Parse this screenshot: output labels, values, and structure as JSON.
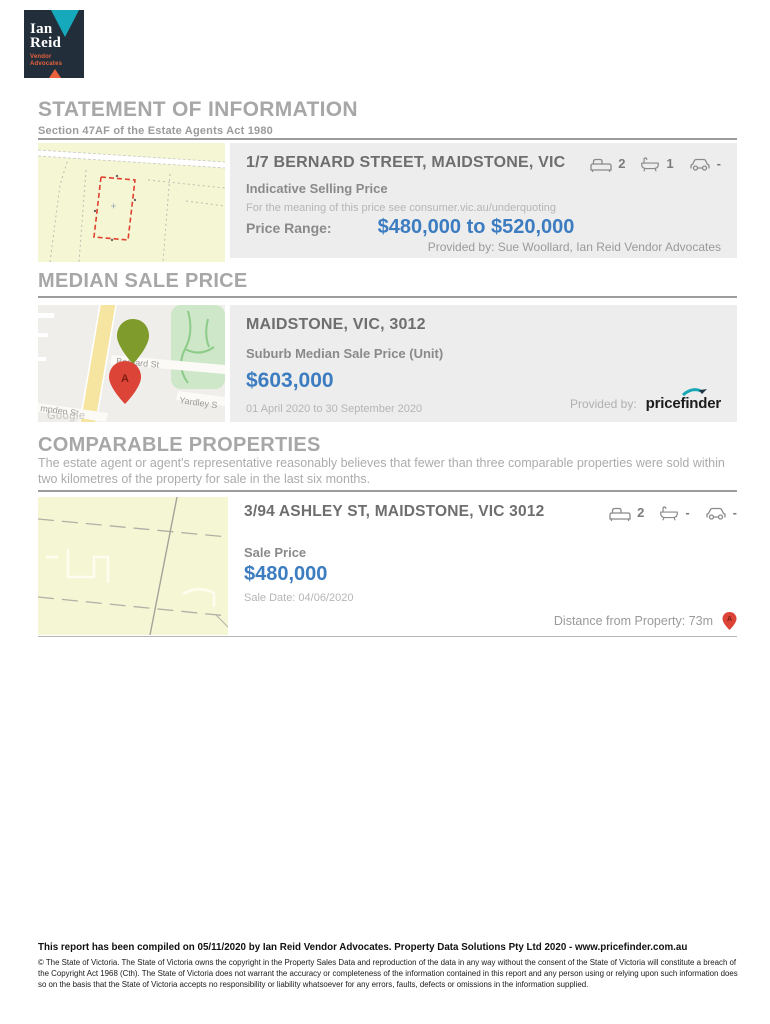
{
  "logo": {
    "name_line1": "Ian",
    "name_line2": "Reid",
    "tagline_line1": "Vendor",
    "tagline_line2": "Advocates"
  },
  "header": {
    "title": "STATEMENT OF INFORMATION",
    "subtitle": "Section 47AF of the Estate Agents Act 1980"
  },
  "subject": {
    "address": "1/7 BERNARD STREET, MAIDSTONE, VIC",
    "beds": "2",
    "baths": "1",
    "cars": "-",
    "price_section_title": "Indicative Selling Price",
    "price_note": "For the meaning of this price see consumer.vic.au/underquoting",
    "price_range_label": "Price Range:",
    "price_range_value": "$480,000 to $520,000",
    "provided_by": "Provided by: Sue Woollard, Ian Reid Vendor Advocates"
  },
  "median": {
    "section_title": "MEDIAN SALE PRICE",
    "locality": "MAIDSTONE, VIC, 3012",
    "metric_label": "Suburb Median Sale Price (Unit)",
    "metric_value": "$603,000",
    "period": "01 April 2020 to 30 September 2020",
    "provided_by_label": "Provided by:",
    "provider_name": "pricefinder",
    "map": {
      "street_main": "Bernard St",
      "street_right": "Yardley S",
      "street_bottom": "mpden St",
      "watermark": "Google",
      "pin_letter": "A"
    }
  },
  "comparables": {
    "section_title": "COMPARABLE PROPERTIES",
    "disclaimer": "The estate agent or agent's representative reasonably believes that fewer than three comparable properties were sold within two kilometres of the property for sale in the last six months.",
    "items": [
      {
        "address": "3/94 ASHLEY ST, MAIDSTONE, VIC 3012",
        "beds": "2",
        "baths": "-",
        "cars": "-",
        "sale_price_label": "Sale Price",
        "sale_price": "$480,000",
        "sale_date": "Sale Date: 04/06/2020",
        "distance_label": "Distance from Property: 73m",
        "pin_letter": "A"
      }
    ]
  },
  "footer": {
    "compiled_line": "This report has been compiled on 05/11/2020 by Ian Reid Vendor Advocates. Property Data Solutions Pty Ltd 2020 - www.pricefinder.com.au",
    "copyright_text": "© The State of Victoria. The State of Victoria owns the copyright in the Property Sales Data and reproduction of the data in any way without the consent of the State of Victoria will constitute a breach of the Copyright Act 1968 (Cth). The State of Victoria does not warrant the accuracy or completeness of the information contained in this report and any person using or relying upon such information does so on the basis that the State of Victoria accepts no responsibility or liability whatsoever for any errors, faults, defects or omissions in the information supplied."
  },
  "colors": {
    "price_blue": "#3c7cc0",
    "panel_gray": "#ededed",
    "heading_gray": "#a7a7a7",
    "brand_navy": "#222e3a",
    "brand_teal": "#16a9bb",
    "brand_orange": "#e8613c",
    "pin_red": "#dc4437",
    "pin_green": "#7e9b2b",
    "map_yellow": "#f5f7d4",
    "park_green": "#cee7c8"
  }
}
